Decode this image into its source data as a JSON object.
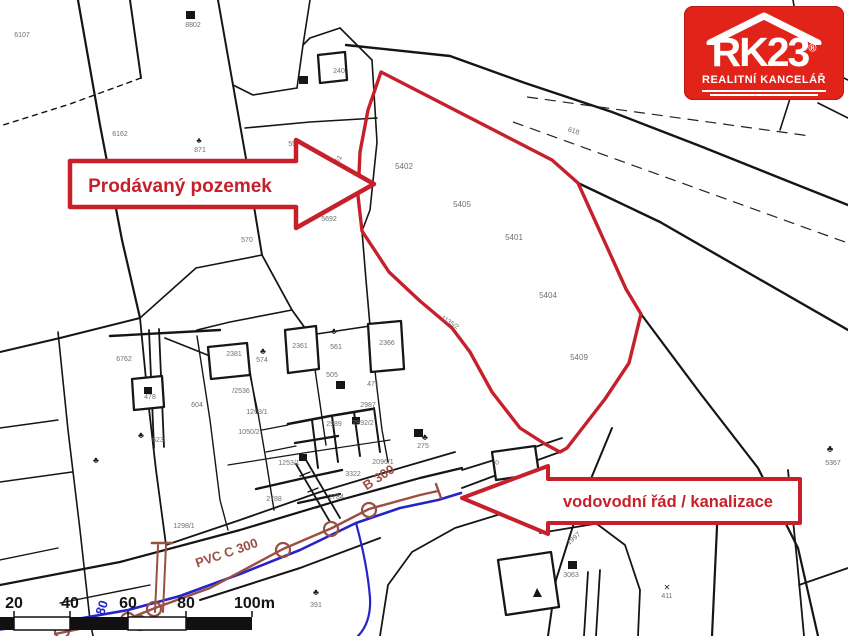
{
  "logo": {
    "brand": "RK23",
    "registered": "®",
    "tagline": "REALITNÍ KANCELÁŘ",
    "bg_color": "#e2231a"
  },
  "callouts": {
    "color": "#c6212b",
    "sale": {
      "label": "Prodávaný pozemek"
    },
    "utility": {
      "label": "vodovodní řád / kanalizace"
    }
  },
  "highlight": {
    "color": "#c6212b",
    "parcels_inside": [
      "5402",
      "5405",
      "5401",
      "5404",
      "5409"
    ]
  },
  "utilities": {
    "water": {
      "color": "#2424c8",
      "diameter_label": "80"
    },
    "sewer": {
      "color": "#9a4f43",
      "labels": [
        "PVC C 300",
        "B 300"
      ]
    }
  },
  "scalebar": {
    "labels": [
      "20",
      "40",
      "60",
      "80",
      "100m"
    ]
  },
  "map_labels": [
    {
      "t": "6107",
      "x": 22,
      "y": 37
    },
    {
      "t": "8802",
      "x": 193,
      "y": 27
    },
    {
      "t": "6162",
      "x": 120,
      "y": 136
    },
    {
      "t": "871",
      "x": 200,
      "y": 152
    },
    {
      "t": "5504",
      "x": 296,
      "y": 146
    },
    {
      "t": "561",
      "x": 339,
      "y": 162,
      "r": -55
    },
    {
      "t": "5692",
      "x": 329,
      "y": 221
    },
    {
      "t": "618",
      "x": 573,
      "y": 133,
      "r": 18
    },
    {
      "t": "240",
      "x": 339,
      "y": 73
    },
    {
      "t": "570",
      "x": 247,
      "y": 242
    },
    {
      "t": "5402",
      "x": 404,
      "y": 169,
      "s": 8
    },
    {
      "t": "5405",
      "x": 462,
      "y": 207,
      "s": 8
    },
    {
      "t": "5401",
      "x": 514,
      "y": 240,
      "s": 8
    },
    {
      "t": "5404",
      "x": 548,
      "y": 298,
      "s": 8
    },
    {
      "t": "5409",
      "x": 579,
      "y": 360,
      "s": 8
    },
    {
      "t": "1135/2",
      "x": 449,
      "y": 324,
      "r": 33,
      "s": 6.5
    },
    {
      "t": "6762",
      "x": 124,
      "y": 361
    },
    {
      "t": "478",
      "x": 150,
      "y": 399
    },
    {
      "t": "604",
      "x": 197,
      "y": 407
    },
    {
      "t": "623",
      "x": 158,
      "y": 442
    },
    {
      "t": "2381",
      "x": 234,
      "y": 356
    },
    {
      "t": "574",
      "x": 262,
      "y": 362
    },
    {
      "t": "/2536",
      "x": 241,
      "y": 393
    },
    {
      "t": "1263/1",
      "x": 257,
      "y": 414
    },
    {
      "t": "2361",
      "x": 300,
      "y": 348
    },
    {
      "t": "561",
      "x": 336,
      "y": 349
    },
    {
      "t": "2366",
      "x": 387,
      "y": 345
    },
    {
      "t": "505",
      "x": 332,
      "y": 377
    },
    {
      "t": "471",
      "x": 373,
      "y": 386
    },
    {
      "t": "2987",
      "x": 368,
      "y": 407
    },
    {
      "t": "2989",
      "x": 334,
      "y": 426
    },
    {
      "t": "2992/2",
      "x": 363,
      "y": 425
    },
    {
      "t": "1050/2",
      "x": 249,
      "y": 434
    },
    {
      "t": "275",
      "x": 423,
      "y": 448
    },
    {
      "t": "1253/1",
      "x": 289,
      "y": 465
    },
    {
      "t": "2096/1",
      "x": 383,
      "y": 464
    },
    {
      "t": "3322",
      "x": 353,
      "y": 476
    },
    {
      "t": "2788",
      "x": 274,
      "y": 501
    },
    {
      "t": "2784",
      "x": 336,
      "y": 499
    },
    {
      "t": "1298/1",
      "x": 184,
      "y": 528
    },
    {
      "t": "391",
      "x": 316,
      "y": 607
    },
    {
      "t": "3063",
      "x": 571,
      "y": 577
    },
    {
      "t": "1997",
      "x": 575,
      "y": 540,
      "r": -40
    },
    {
      "t": "411",
      "x": 667,
      "y": 598
    },
    {
      "t": "5367",
      "x": 833,
      "y": 465
    },
    {
      "t": "PVC C 300",
      "x": 228,
      "y": 557,
      "r": -19,
      "s": 13,
      "c": "m",
      "w": 700
    },
    {
      "t": "B 300",
      "x": 381,
      "y": 481,
      "r": -33,
      "s": 13,
      "c": "m",
      "w": 700
    },
    {
      "t": "80",
      "x": 106,
      "y": 609,
      "r": -72,
      "s": 13,
      "c": "b",
      "w": 700
    },
    {
      "t": "♣",
      "x": 263,
      "y": 354,
      "s": 9,
      "c": "d"
    },
    {
      "t": "♣",
      "x": 334,
      "y": 334,
      "s": 9,
      "c": "d"
    },
    {
      "t": "♣",
      "x": 425,
      "y": 440,
      "s": 9,
      "c": "d"
    },
    {
      "t": "♣",
      "x": 316,
      "y": 595,
      "s": 9,
      "c": "d"
    },
    {
      "t": "♣",
      "x": 96,
      "y": 463,
      "s": 9,
      "c": "d"
    },
    {
      "t": "♣",
      "x": 141,
      "y": 438,
      "s": 9,
      "c": "d"
    },
    {
      "t": "♣",
      "x": 830,
      "y": 452,
      "s": 10,
      "c": "d"
    },
    {
      "t": "♣",
      "x": 199,
      "y": 143,
      "s": 8,
      "c": "d"
    },
    {
      "t": "✕",
      "x": 667,
      "y": 590,
      "s": 8,
      "c": "d"
    },
    {
      "t": "◇",
      "x": 497,
      "y": 464,
      "s": 6,
      "c": "d"
    }
  ]
}
